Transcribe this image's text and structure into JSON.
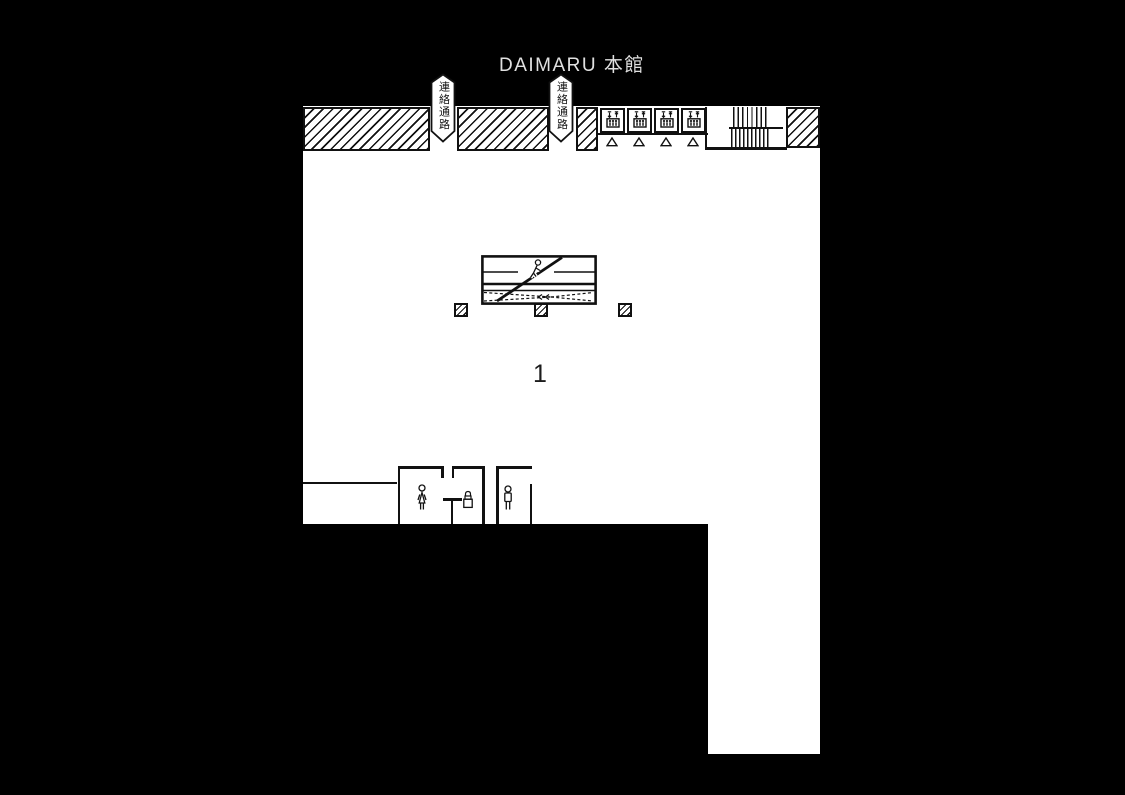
{
  "header": {
    "title": "DAIMARU 本館"
  },
  "map": {
    "floor_number": "1",
    "passage_banner_left": "連絡通路",
    "passage_banner_right": "連絡通路"
  },
  "icons": {
    "elevator": "elevator-icon",
    "elevator_door_marker": "triangle-marker",
    "stairs": "staircase-steps",
    "escalator_person": "escalator-person-icon",
    "womens_restroom": "woman-icon",
    "lock": "lock-icon",
    "mens_restroom": "man-icon",
    "pillar": "hatched-pillar"
  },
  "colors": {
    "background": "#000000",
    "floor": "#ffffff",
    "line": "#111111",
    "title_text": "#e0e0e0"
  }
}
